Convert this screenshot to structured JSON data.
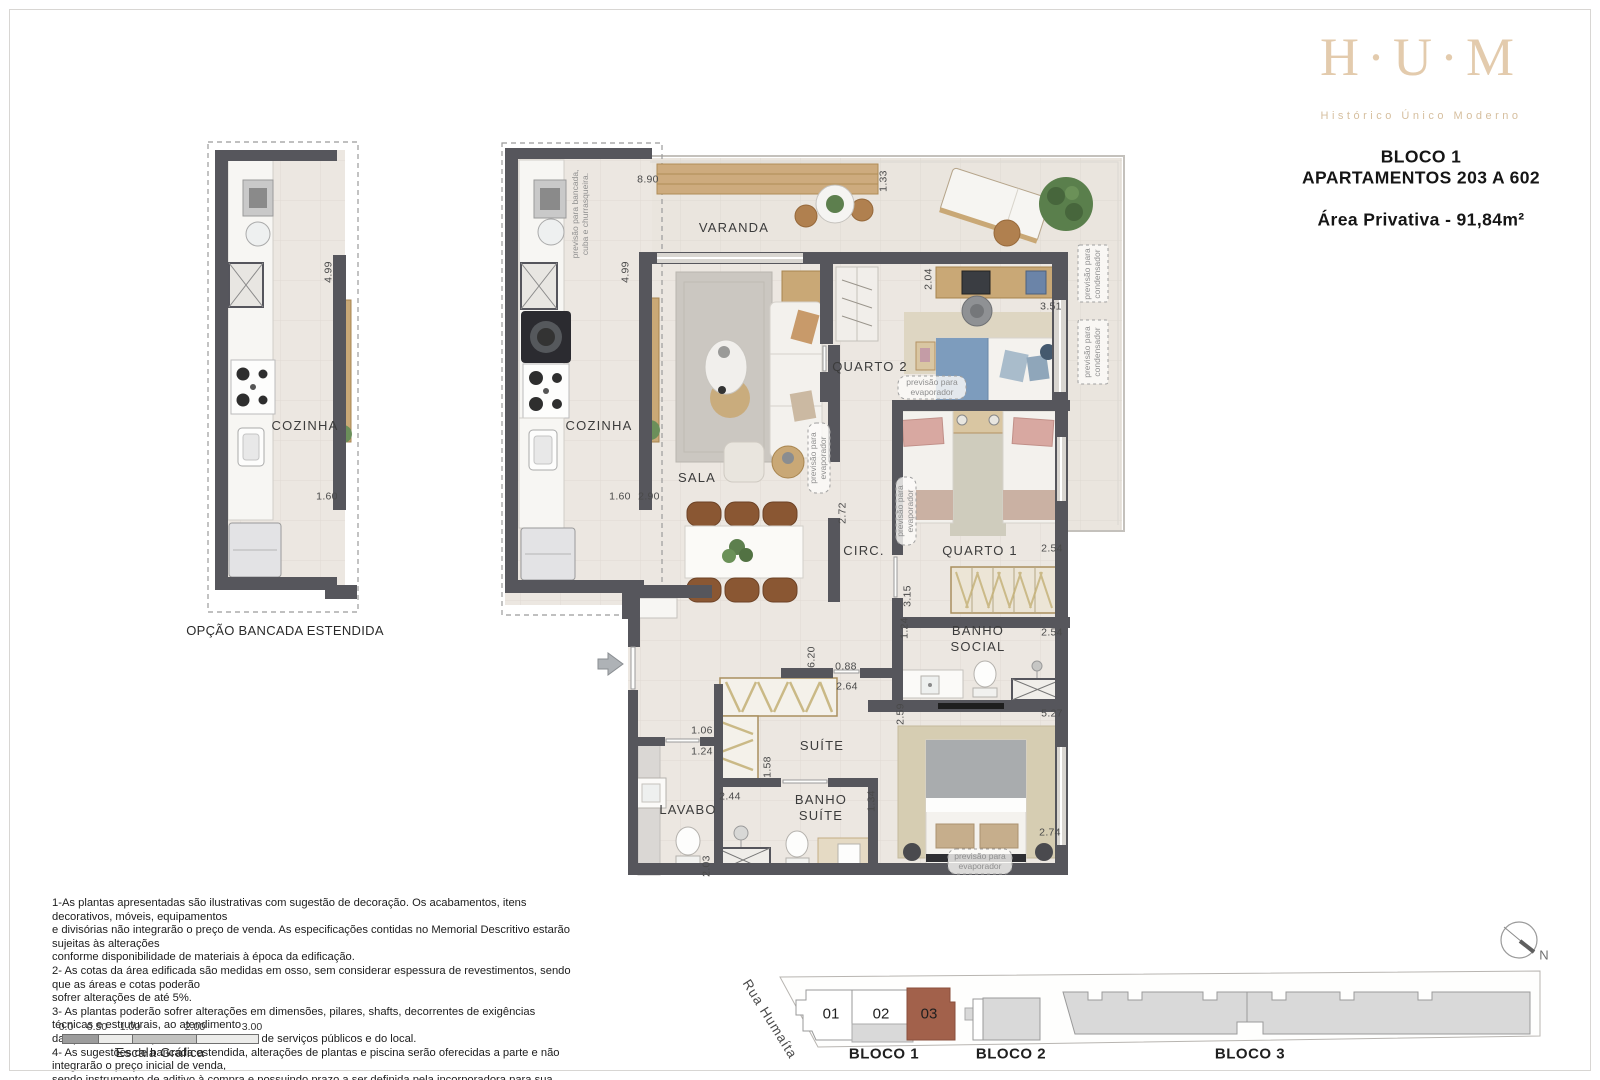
{
  "header": {
    "logo": "H·U·M",
    "tagline": "Histórico Único Moderno",
    "block_line1": "BLOCO 1",
    "block_line2": "APARTAMENTOS 203 A 602",
    "area": "Área Privativa - 91,84m²"
  },
  "option_plan": {
    "caption": "OPÇÃO BANCADA ESTENDIDA"
  },
  "plan": {
    "labels": [
      {
        "t": "VARANDA",
        "x": 734,
        "y": 228,
        "c": "room",
        "n": "room-label-varanda"
      },
      {
        "t": "COZINHA",
        "x": 599,
        "y": 426,
        "c": "room",
        "n": "room-label-cozinha"
      },
      {
        "t": "SALA",
        "x": 697,
        "y": 478,
        "c": "room",
        "n": "room-label-sala"
      },
      {
        "t": "QUARTO 2",
        "x": 870,
        "y": 367,
        "c": "room",
        "n": "room-label-quarto2"
      },
      {
        "t": "CIRC.",
        "x": 864,
        "y": 551,
        "c": "room",
        "n": "room-label-circ"
      },
      {
        "t": "QUARTO 1",
        "x": 980,
        "y": 551,
        "c": "room",
        "n": "room-label-quarto1"
      },
      {
        "t": "BANHO\nSOCIAL",
        "x": 978,
        "y": 639,
        "c": "room",
        "n": "room-label-banho-social"
      },
      {
        "t": "SUÍTE",
        "x": 822,
        "y": 746,
        "c": "room",
        "n": "room-label-suite"
      },
      {
        "t": "LAVABO",
        "x": 688,
        "y": 810,
        "c": "room",
        "n": "room-label-lavabo"
      },
      {
        "t": "BANHO\nSUÍTE",
        "x": 821,
        "y": 808,
        "c": "room",
        "n": "room-label-banho-suite"
      },
      {
        "t": "COZINHA",
        "x": 305,
        "y": 426,
        "c": "room",
        "n": "room-label-cozinha-opcao"
      },
      {
        "t": "8.90",
        "x": 648,
        "y": 180,
        "c": "dim",
        "n": "dim-label"
      },
      {
        "t": "1.33",
        "x": 884,
        "y": 181,
        "r": -90,
        "c": "dim",
        "n": "dim-label"
      },
      {
        "t": "4.99",
        "x": 626,
        "y": 272,
        "r": -90,
        "c": "dim",
        "n": "dim-label"
      },
      {
        "t": "2.04",
        "x": 929,
        "y": 279,
        "r": -90,
        "c": "dim",
        "n": "dim-label"
      },
      {
        "t": "3.51",
        "x": 1051,
        "y": 307,
        "c": "dim",
        "n": "dim-label"
      },
      {
        "t": "1.60",
        "x": 620,
        "y": 497,
        "c": "dim",
        "n": "dim-label"
      },
      {
        "t": "2.90",
        "x": 649,
        "y": 497,
        "c": "dim",
        "n": "dim-label"
      },
      {
        "t": "2.72",
        "x": 843,
        "y": 513,
        "r": -90,
        "c": "dim",
        "n": "dim-label"
      },
      {
        "t": "2.54",
        "x": 1052,
        "y": 549,
        "c": "dim",
        "n": "dim-label"
      },
      {
        "t": "3.15",
        "x": 908,
        "y": 596,
        "r": -90,
        "c": "dim",
        "n": "dim-label"
      },
      {
        "t": "1.24",
        "x": 905,
        "y": 628,
        "r": -90,
        "c": "dim",
        "n": "dim-label"
      },
      {
        "t": "2.54",
        "x": 1052,
        "y": 633,
        "c": "dim",
        "n": "dim-label"
      },
      {
        "t": "6.20",
        "x": 812,
        "y": 657,
        "r": -90,
        "c": "dim",
        "n": "dim-label"
      },
      {
        "t": "0.88",
        "x": 846,
        "y": 667,
        "c": "dim",
        "n": "dim-label"
      },
      {
        "t": "2.64",
        "x": 847,
        "y": 687,
        "c": "dim",
        "n": "dim-label"
      },
      {
        "t": "5.27",
        "x": 1052,
        "y": 714,
        "c": "dim",
        "n": "dim-label"
      },
      {
        "t": "2.59",
        "x": 901,
        "y": 714,
        "r": -90,
        "c": "dim",
        "n": "dim-label"
      },
      {
        "t": "1.06",
        "x": 702,
        "y": 731,
        "c": "dim",
        "n": "dim-label"
      },
      {
        "t": "1.24",
        "x": 702,
        "y": 752,
        "c": "dim",
        "n": "dim-label"
      },
      {
        "t": "1.58",
        "x": 768,
        "y": 767,
        "r": -90,
        "c": "dim",
        "n": "dim-label"
      },
      {
        "t": "2.44",
        "x": 730,
        "y": 797,
        "c": "dim",
        "n": "dim-label"
      },
      {
        "t": "1.34",
        "x": 872,
        "y": 801,
        "r": -90,
        "c": "dim",
        "n": "dim-label"
      },
      {
        "t": "2.74",
        "x": 1050,
        "y": 833,
        "c": "dim",
        "n": "dim-label"
      },
      {
        "t": "2.03",
        "x": 707,
        "y": 866,
        "r": -90,
        "c": "dim",
        "n": "dim-label"
      },
      {
        "t": "4.99",
        "x": 329,
        "y": 272,
        "r": -90,
        "c": "dim",
        "n": "dim-label"
      },
      {
        "t": "1.60",
        "x": 327,
        "y": 497,
        "c": "dim",
        "n": "dim-label"
      },
      {
        "t": "previsão para bancada,\ncuba e churrasqueira.",
        "x": 581,
        "y": 214,
        "r": -90,
        "c": "ann",
        "n": "annotation-bancada"
      },
      {
        "t": "previsão para\nevaporador",
        "x": 819,
        "y": 458,
        "r": -90,
        "c": "ann",
        "n": "annotation-evaporador"
      },
      {
        "t": "previsão para\nevaporador",
        "x": 906,
        "y": 511,
        "r": -90,
        "c": "ann",
        "n": "annotation-evaporador"
      },
      {
        "t": "previsão para\nevaporador",
        "x": 932,
        "y": 388,
        "c": "ann",
        "n": "annotation-evaporador"
      },
      {
        "t": "previsão para\nevaporador",
        "x": 980,
        "y": 862,
        "c": "ann",
        "n": "annotation-evaporador"
      },
      {
        "t": "previsão para\ncondensador",
        "x": 1093,
        "y": 274,
        "r": -90,
        "c": "ann",
        "n": "annotation-condensador"
      },
      {
        "t": "previsão para\ncondensador",
        "x": 1093,
        "y": 352,
        "r": -90,
        "c": "ann",
        "n": "annotation-condensador"
      }
    ]
  },
  "disclaimer": {
    "lines": [
      "1-As plantas apresentadas são ilustrativas com sugestão de decoração. Os acabamentos, itens decorativos, móveis, equipamentos",
      "e divisórias não integrarão o preço de venda. As especificações contidas no Memorial Descritivo estarão sujeitas às alterações",
      "conforme disponibilidade de materiais à época da edificação.",
      "2- As cotas da área edificada são medidas em osso, sem considerar espessura de revestimentos, sendo que as áreas e cotas poderão",
      "sofrer alterações de até 5%.",
      "3- As plantas poderão sofrer alterações em dimensões, pilares, shafts, decorrentes de exigências técnicas e estruturais, ao atendimento",
      "das posturas municipais, concessionárias de serviços públicos e do local.",
      "4- As sugestões de bancada estendida, alterações de plantas e piscina serão oferecidas a parte e não integrarão o preço inicial de venda,",
      "sendo instrumento de aditivo à compra e possuindo prazo a ser definida pela incorporadora para sua aquisição."
    ]
  },
  "scale_bar": {
    "ticks": [
      "0.0",
      "0.50",
      "1.00",
      "2.00",
      "3.00"
    ],
    "caption": "Escala Gráfica"
  },
  "site_plan": {
    "street": "Rua Humaíta",
    "units": [
      {
        "label": "01"
      },
      {
        "label": "02"
      },
      {
        "label": "03"
      }
    ],
    "blocks": [
      {
        "label": "BLOCO 1"
      },
      {
        "label": "BLOCO 2"
      },
      {
        "label": "BLOCO 3"
      }
    ],
    "north": "N",
    "highlight_color": "#a2614b"
  }
}
